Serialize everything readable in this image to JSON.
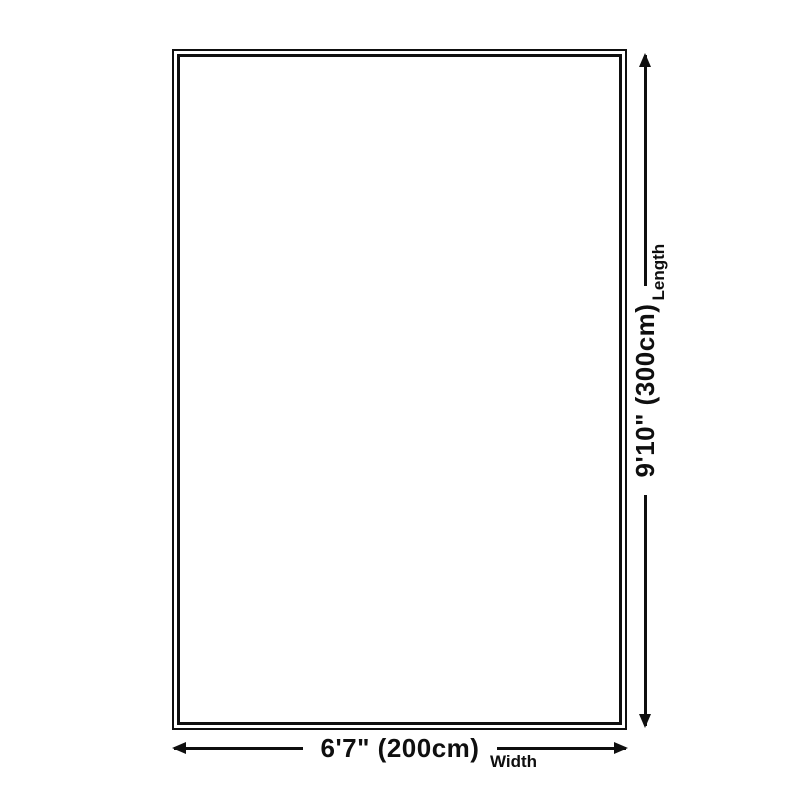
{
  "page": {
    "background_color": "#ffffff",
    "ink_color": "#0f0f0f"
  },
  "diagram": {
    "type": "product-dimension-diagram",
    "outline": {
      "style": "double-border-rectangle"
    },
    "width_dimension": {
      "value": "6'7\" (200cm)",
      "label": "Width",
      "arrow": "horizontal-double-headed"
    },
    "length_dimension": {
      "value": "9'10\" (300cm)",
      "label": "Length",
      "arrow": "vertical-double-headed"
    }
  }
}
